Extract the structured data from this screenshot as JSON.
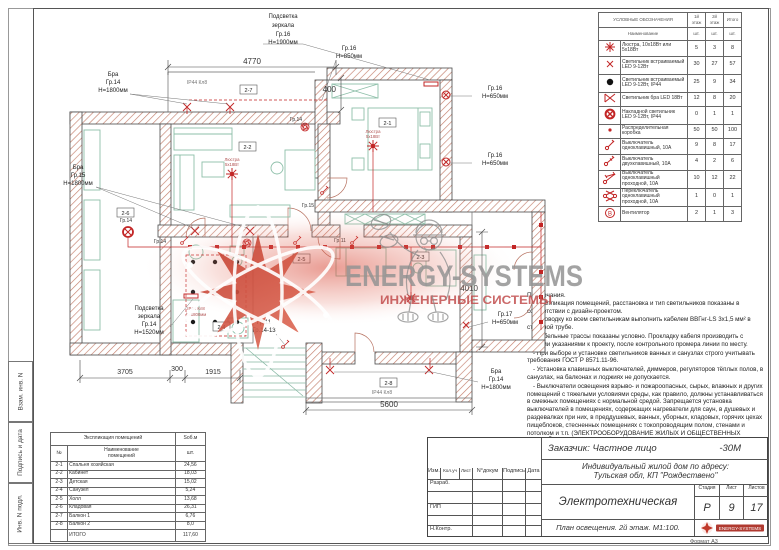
{
  "watermark": {
    "title": "ENERGY-SYSTEMS",
    "subtitle": "ИНЖЕНЕРНЫЕ СИСТЕМЫ"
  },
  "side_stamp": {
    "c1": "Взам. инв. N",
    "c2": "Подпись и дата",
    "c3": "Инв. N подл."
  },
  "legend": {
    "title": "УСЛОВНЫЕ ОБОЗНАЧЕНИЯ",
    "floor1": "1й этаж",
    "floor2": "2й этаж",
    "total": "Итого",
    "name_col": "Наименование",
    "unit": "шт.",
    "rows": [
      {
        "name": "Люстра, 10х18Вт или 5х18Вт",
        "c1": "5",
        "c2": "3",
        "c3": "8"
      },
      {
        "name": "Светильник встраиваемый LED 9-12Вт",
        "c1": "30",
        "c2": "27",
        "c3": "57"
      },
      {
        "name": "Светильник встраиваемый LED 9-12Вт, IP44",
        "c1": "25",
        "c2": "9",
        "c3": "34"
      },
      {
        "name": "Светильник бра LED 18Вт",
        "c1": "12",
        "c2": "8",
        "c3": "20"
      },
      {
        "name": "Накладной светильник LED 9-12Вт, IP44",
        "c1": "0",
        "c2": "1",
        "c3": "1"
      },
      {
        "name": "Распределительная коробка",
        "c1": "50",
        "c2": "50",
        "c3": "100"
      },
      {
        "name": "Выключатель одноклавишный, 10А",
        "c1": "9",
        "c2": "8",
        "c3": "17"
      },
      {
        "name": "Выключатель двухклавишный, 10А",
        "c1": "4",
        "c2": "2",
        "c3": "6"
      },
      {
        "name": "Выключатель одноклавишный проходной, 10А",
        "c1": "10",
        "c2": "12",
        "c3": "22"
      },
      {
        "name": "Переключатель одноклавишный проходной, 10А",
        "c1": "1",
        "c2": "0",
        "c3": "1"
      },
      {
        "name": "Вентилятор",
        "c1": "2",
        "c2": "1",
        "c3": "3"
      }
    ]
  },
  "notes": {
    "title": "Примечания.",
    "items": [
      "- Экспликация помещений, расстановка и тип светильников показаны в соответствии с дизайн-проектом.",
      "- Проводку ко всем светильникам выполнить кабелем ВВГнг-LS 3х1,5 мм² в стальной трубе.",
      "- Кабельные трассы показаны условно. Прокладку кабеля производить с общими указаниями к проекту, после контрольного промера линии по месту.",
      "- При выборе и установке светильников ванных и санузлах строго учитывать требования ГОСТ Р 8571.11-96.",
      "- Установка клавишных выключателей, диммеров, регуляторов тёплых полов, в санузлах, на балконах и лоджиях не допускается.",
      "- Выключатели освещения взрыво- и пожароопасных, сырых, влажных и других помещений с тяжелыми условиями среды, как правило, должны устанавливаться в смежных помещениях с нормальной средой. Запрещается установка выключателей в помещениях, содержащих нагреватели для саун, в душевых и раздевалках при них, в преддушевых, ванных, уборных, кладовых, горячих цехах пищеблоков, стесненных помещениях с токопроводящим полом, стенами и потолком и т.п. (ЭЛЕКТРООБОРУДОВАНИЕ ЖИЛЫХ И ОБЩЕСТВЕННЫХ ЗДАНИЙ - СП 31-110-2003)."
    ]
  },
  "rooms_table": {
    "title": "Экспликация помещений",
    "area_col": "Sоб.м",
    "num_col": "№",
    "name_col1": "Наименование",
    "name_col2": "помещений",
    "unit": "шт.",
    "rows": [
      {
        "n": "2-1",
        "name": "Спальня хозяйская",
        "s": "24,56"
      },
      {
        "n": "2-2",
        "name": "Кабинет",
        "s": "18,03"
      },
      {
        "n": "2-3",
        "name": "Детская",
        "s": "15,02"
      },
      {
        "n": "2-4",
        "name": "Санузел",
        "s": "5,24"
      },
      {
        "n": "2-5",
        "name": "Холл",
        "s": "13,68"
      },
      {
        "n": "2-6",
        "name": "Кладовая",
        "s": "26,31"
      },
      {
        "n": "2-7",
        "name": "Балкон 1",
        "s": "6,76"
      },
      {
        "n": "2-8",
        "name": "Балкон 2",
        "s": "8,0"
      }
    ],
    "total_label": "ИТОГО",
    "total_value": "117,60"
  },
  "title_block": {
    "customer": "Заказчик: Частное лицо",
    "code": "-30М",
    "object_line1": "Индивидуальный жилой дом по адресу:",
    "object_line2": "Тульская обл, КП \"Рождествено\"",
    "cols": {
      "c0": "Изм.",
      "c1": "Кол.уч",
      "c2": "Лист",
      "c3": "N°докум",
      "c4": "Подпись",
      "c5": "Дата"
    },
    "roles": {
      "r0": "Разраб.",
      "r1": "ГИП",
      "r2": "Н.Контр."
    },
    "section_title": "Электротехническая часть",
    "stage_label": "Стадия",
    "sheet_label": "Лист",
    "sheets_label": "Листов",
    "stage": "Р",
    "sheet": "9",
    "sheets": "17",
    "drawing_title": "План освещения. 2й этаж. М1:100.",
    "format": "Формат А3"
  },
  "plan": {
    "dims": {
      "top": "4770",
      "niche": "400",
      "right": "4010",
      "d1": "3705",
      "d2": "300",
      "d3": "1915",
      "bottom": "5600"
    },
    "rooms": [
      "2-1",
      "2-2",
      "2-3",
      "2-4",
      "2-5",
      "2-6",
      "2-7",
      "2-8"
    ],
    "labels": {
      "mirror_top": [
        "Подсветка",
        "зеркала",
        "Гр.16",
        "Н=1900мм"
      ],
      "gr16_850": [
        "Гр.16",
        "Н=850мм"
      ],
      "bra_top": [
        "Бра",
        "Гр.14",
        "Н=1800мм"
      ],
      "bra_left": [
        "Бра",
        "Гр.15",
        "Н=1800мм"
      ],
      "gr16_650a": [
        "Гр.16",
        "Н=650мм"
      ],
      "gr16_650b": [
        "Гр.16",
        "Н=650мм"
      ],
      "gr17_650": [
        "Гр.17",
        "Н=650мм"
      ],
      "bra_bottom": [
        "Бра",
        "Гр.14",
        "Н=1800мм"
      ],
      "mirror_bath": [
        "Подсветка",
        "зеркала",
        "Гр.14",
        "Н=1520мм"
      ],
      "stairs": [
        "Гр.11",
        "Гр.14-13"
      ],
      "gr14_fan": "Гр.14",
      "gr15": "Гр.15",
      "gr14_hall": "Гр.14",
      "gr14_storage": "Гр.14",
      "gr11": "Гр.11",
      "ip44_top": "IP44 Кл8",
      "ip44_balcony": "IP44 Кл8",
      "ip44_bath": [
        "IP44 Кл8",
        "h=1800мм"
      ],
      "chandelier_a": [
        "Люстра",
        "5х18Вт"
      ],
      "chandelier_b": [
        "Люстра",
        "5х18Вт"
      ]
    }
  }
}
